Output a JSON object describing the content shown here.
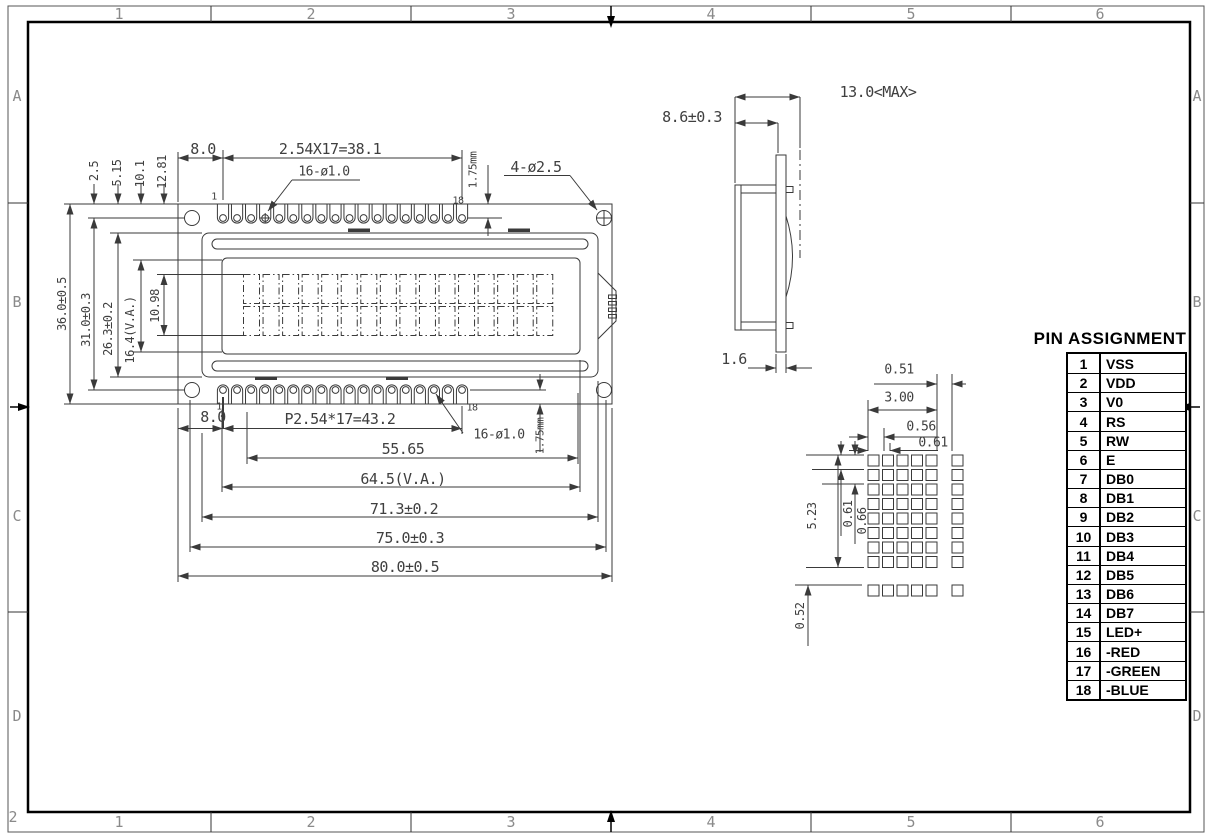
{
  "border": {
    "columns": [
      "1",
      "2",
      "3",
      "4",
      "5",
      "6"
    ],
    "rows": [
      "A",
      "B",
      "C",
      "D"
    ],
    "corner_mark": "2"
  },
  "front_view": {
    "pin_first": "1",
    "pin_last": "18",
    "top": {
      "edge_offset": "8.0",
      "pin_pitch": "2.54X17=38.1",
      "pin_hole": "16-ø1.0",
      "mount_hole": "4-ø2.5",
      "pin_tail": "1.75mm"
    },
    "top_heights": [
      "2.5",
      "5.15",
      "10.1",
      "12.81"
    ],
    "left_heights": [
      "36.0±0.5",
      "31.0±0.3",
      "26.3±0.2",
      "16.4(V.A.)",
      "10.98"
    ],
    "bottom": {
      "edge_offset": "8.0",
      "pin_pitch": "P2.54*17=43.2",
      "pin_hole": "16-ø1.0",
      "pin_tail": "1.75mm"
    },
    "bottom_widths": [
      "55.65",
      "64.5(V.A.)",
      "71.3±0.2",
      "75.0±0.3",
      "80.0±0.5"
    ]
  },
  "side_view": {
    "depth_max": "13.0<MAX>",
    "pcb_to_front": "8.6±0.3",
    "pcb_thickness": "1.6"
  },
  "dot_detail": {
    "col_gap": "0.51",
    "char_width": "3.00",
    "dot_w1": "0.56",
    "dot_w2": "0.61",
    "char_height": "5.23",
    "dot_h1": "0.61",
    "dot_h2": "0.66",
    "row_gap": "0.52"
  },
  "pin_table": {
    "title": "PIN ASSIGNMENT",
    "rows": [
      {
        "pin": "1",
        "name": "VSS"
      },
      {
        "pin": "2",
        "name": "VDD"
      },
      {
        "pin": "3",
        "name": "V0"
      },
      {
        "pin": "4",
        "name": "RS"
      },
      {
        "pin": "5",
        "name": "RW"
      },
      {
        "pin": "6",
        "name": "E"
      },
      {
        "pin": "7",
        "name": "DB0"
      },
      {
        "pin": "8",
        "name": "DB1"
      },
      {
        "pin": "9",
        "name": "DB2"
      },
      {
        "pin": "10",
        "name": "DB3"
      },
      {
        "pin": "11",
        "name": "DB4"
      },
      {
        "pin": "12",
        "name": "DB5"
      },
      {
        "pin": "13",
        "name": "DB6"
      },
      {
        "pin": "14",
        "name": "DB7"
      },
      {
        "pin": "15",
        "name": "LED+"
      },
      {
        "pin": "16",
        "name": "-RED"
      },
      {
        "pin": "17",
        "name": "-GREEN"
      },
      {
        "pin": "18",
        "name": "-BLUE"
      }
    ]
  }
}
